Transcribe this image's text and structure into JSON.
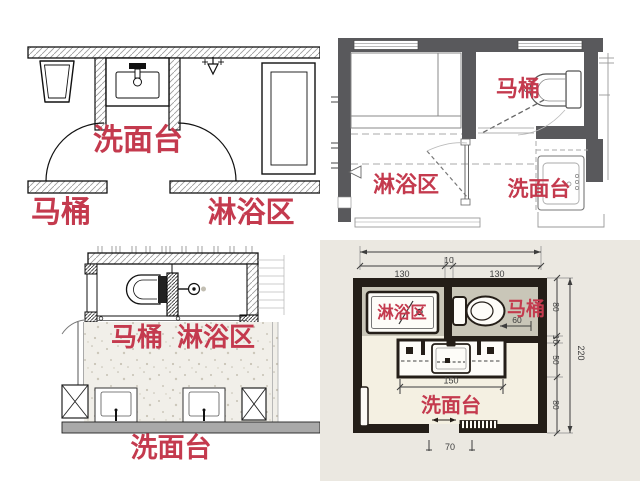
{
  "colors": {
    "label_red": "#c43a4e",
    "wall_gray": "#59595c",
    "wall_black": "#241e18",
    "zone_taupe": "#c9c6b8",
    "zone_cream": "#f4f0e2",
    "dim_gray": "#3d3d3d"
  },
  "plans": {
    "top_left": {
      "washbasin": "洗面台",
      "toilet": "马桶",
      "shower": "淋浴区"
    },
    "top_right": {
      "washbasin": "洗面台",
      "toilet": "马桶",
      "shower": "淋浴区"
    },
    "bottom_left": {
      "washbasin": "洗面台",
      "toilet": "马桶",
      "shower": "淋浴区"
    },
    "bottom_right": {
      "washbasin": "洗面台",
      "toilet": "马桶",
      "shower": "淋浴区",
      "dims": {
        "top_gap": "10",
        "top_left_width": "130",
        "top_right_width": "130",
        "right_top": "80",
        "right_gap": "10",
        "right_mid": "50",
        "right_bottom": "80",
        "right_total": "220",
        "toilet_clearance": "60",
        "basin_width": "150",
        "door_width": "70"
      }
    }
  }
}
